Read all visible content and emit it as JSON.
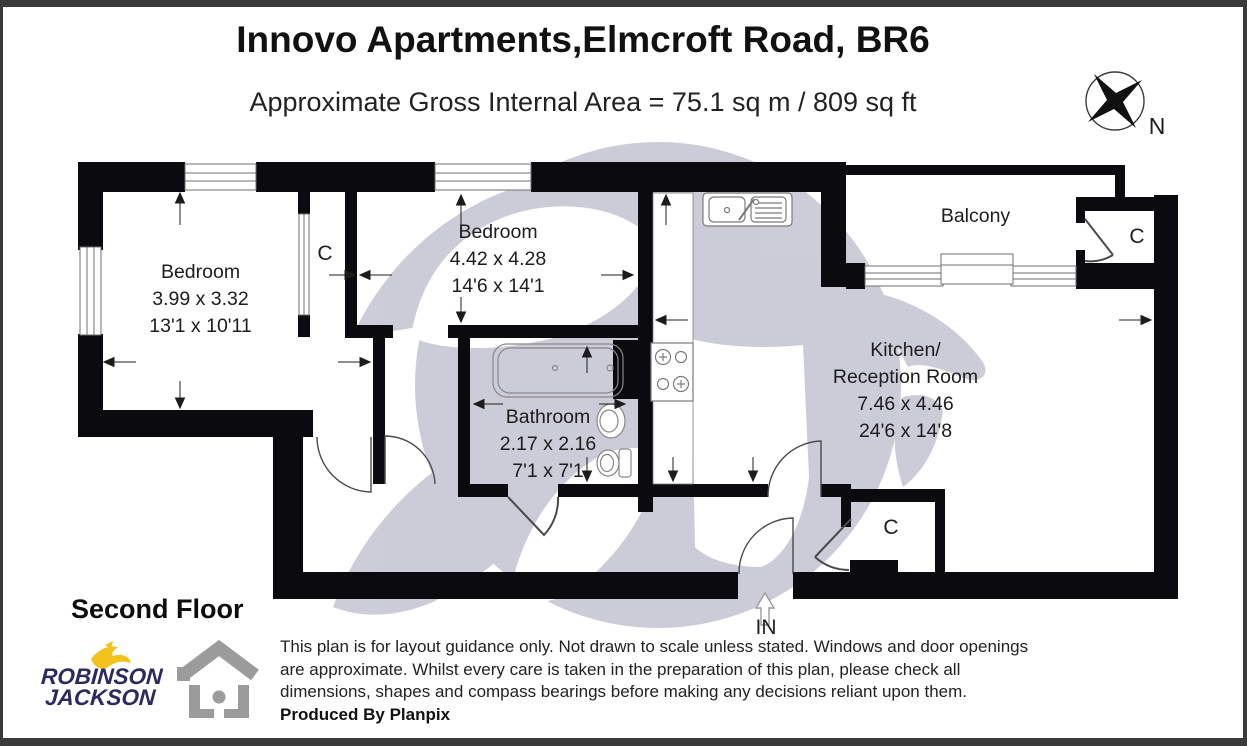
{
  "header": {
    "title": "Innovo Apartments,Elmcroft Road, BR6",
    "subtitle": "Approximate Gross Internal Area = 75.1 sq m / 809 sq ft"
  },
  "compass": {
    "label": "N"
  },
  "floorplan": {
    "rooms": [
      {
        "label": "Bedroom",
        "dim_metric": "3.99 x 3.32",
        "dim_imperial": "13'1 x 10'11"
      },
      {
        "label": "Bedroom",
        "dim_metric": "4.42 x 4.28",
        "dim_imperial": "14'6 x 14'1"
      },
      {
        "label": "Bathroom",
        "dim_metric": "2.17 x 2.16",
        "dim_imperial": "7'1 x 7'1"
      },
      {
        "label": "Kitchen/",
        "label2": "Reception Room",
        "dim_metric": "7.46 x 4.46",
        "dim_imperial": "24'6 x 14'8"
      },
      {
        "label": "Balcony"
      }
    ],
    "closet_label": "C",
    "entrance_label": "IN"
  },
  "footer": {
    "floor_label": "Second Floor",
    "agency": {
      "line1": "ROBINSON",
      "line2": "JACKSON"
    },
    "disclaimer": [
      "This plan is for layout guidance only. Not drawn to scale unless stated. Windows and door openings",
      "are approximate. Whilst every care is taken in the preparation of this plan, please check all",
      "dimensions, shapes and compass bearings before making any decisions reliant upon them."
    ],
    "produced_by": "Produced By Planpix"
  },
  "colors": {
    "wall": "#0a0a0f",
    "watermark": "#c5c6d4",
    "agency_navy": "#2b2a5e",
    "agency_yellow": "#f2c21d",
    "icon_gray": "#9b9b9b"
  }
}
